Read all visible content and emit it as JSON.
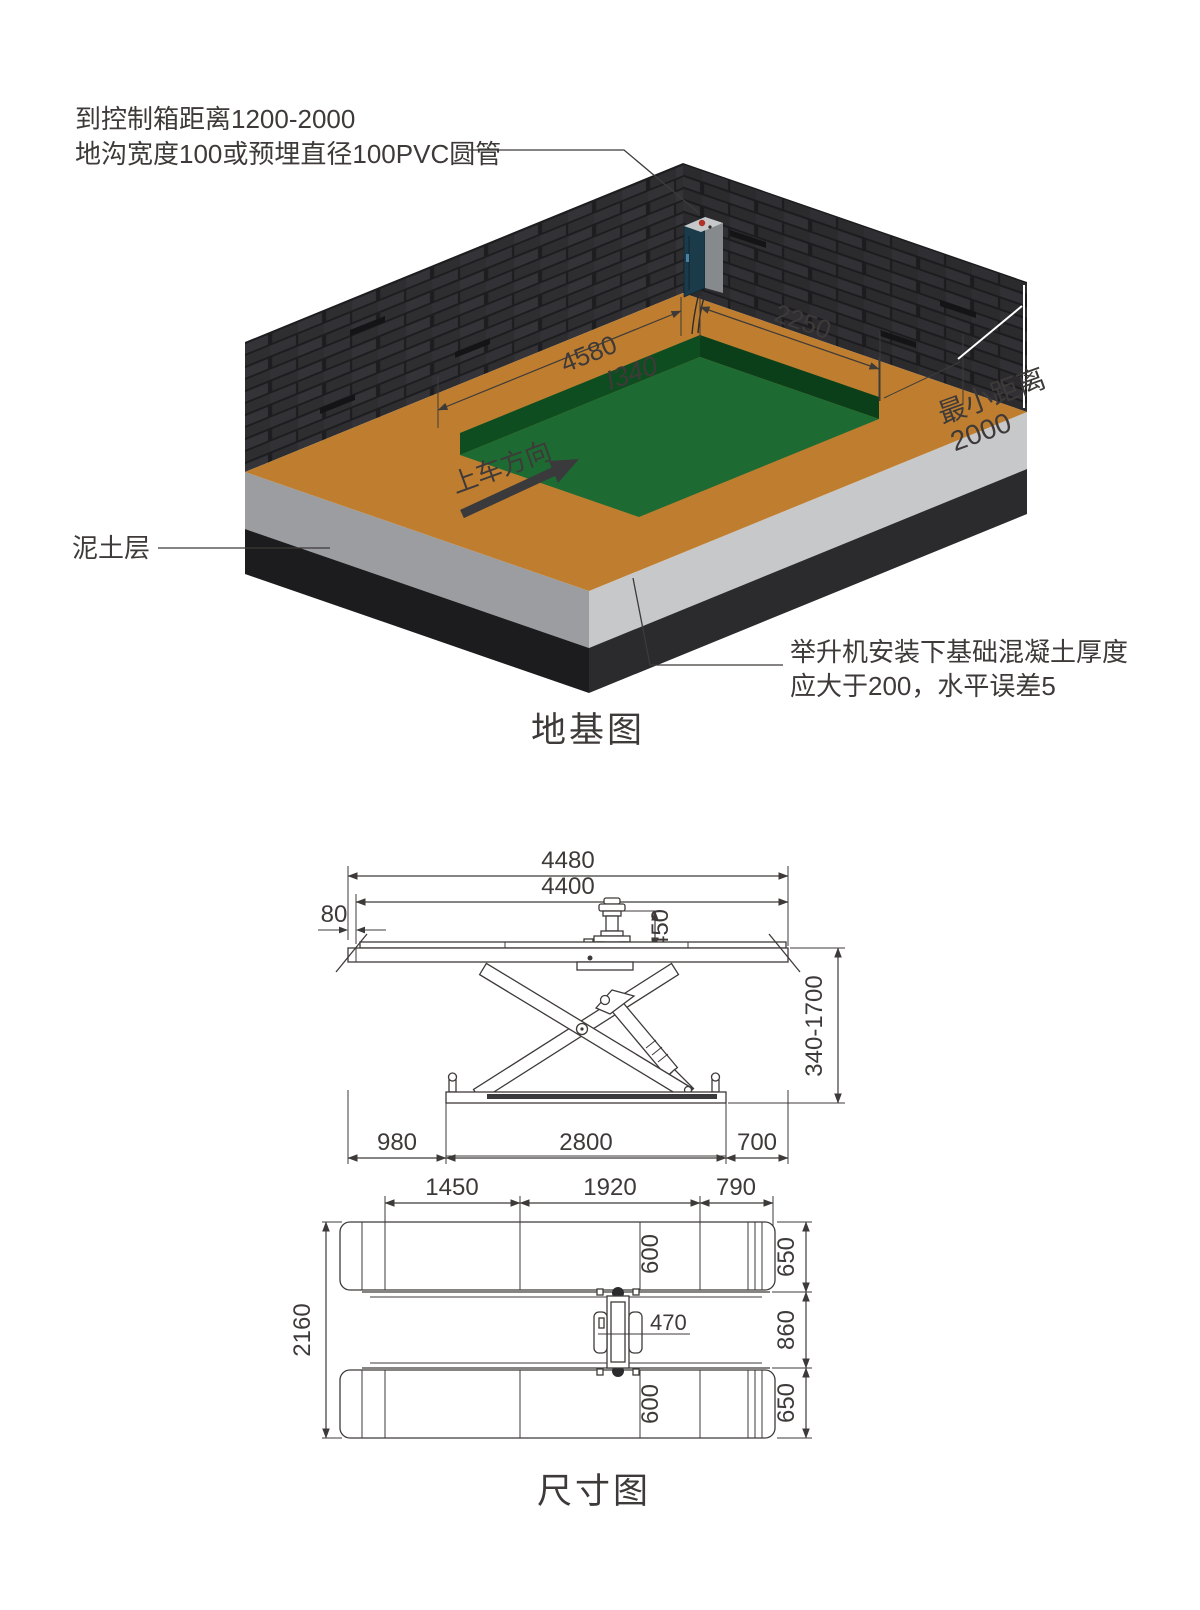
{
  "foundation_view": {
    "title": "地基图",
    "note_control_1": "到控制箱距离1200-2000",
    "note_control_2": "地沟宽度100或预埋直径100PVC圆管",
    "note_soil": "泥土层",
    "note_concrete_1": "举升机安装下基础混凝土厚度",
    "note_concrete_2": "应大于200，水平误差5",
    "min_dist_label": "最小距离",
    "min_dist_value": "2000",
    "drive_dir": "上车方向",
    "dim_pit_length": "4580",
    "dim_pit_width": "2250",
    "dim_pit_depth": "I340"
  },
  "dimension_view": {
    "title": "尺寸图",
    "side": {
      "overall": "4480",
      "platform": "4400",
      "ramp": "80",
      "motor": "450",
      "height_range": "340-1700",
      "d980": "980",
      "d2800": "2800",
      "d700": "700"
    },
    "plan": {
      "d1450": "1450",
      "d1920": "1920",
      "d790": "790",
      "d2160": "2160",
      "d600_top": "600",
      "d600_bottom": "600",
      "d650_top": "650",
      "d860": "860",
      "d650_bottom": "650",
      "d470": "470"
    }
  },
  "colors": {
    "floor": "#bf7e2f",
    "pit_floor": "#1d6b33",
    "pit_wall": "#0e4d20",
    "wall_brick": "#2e2e31",
    "concrete_light": "#c7c8ca",
    "concrete_dark": "#9b9da0",
    "soil": "#1c1c1e",
    "line": "#3e3a39",
    "cabinet": "#1b3a4a",
    "cabinet_red": "#b23227"
  }
}
